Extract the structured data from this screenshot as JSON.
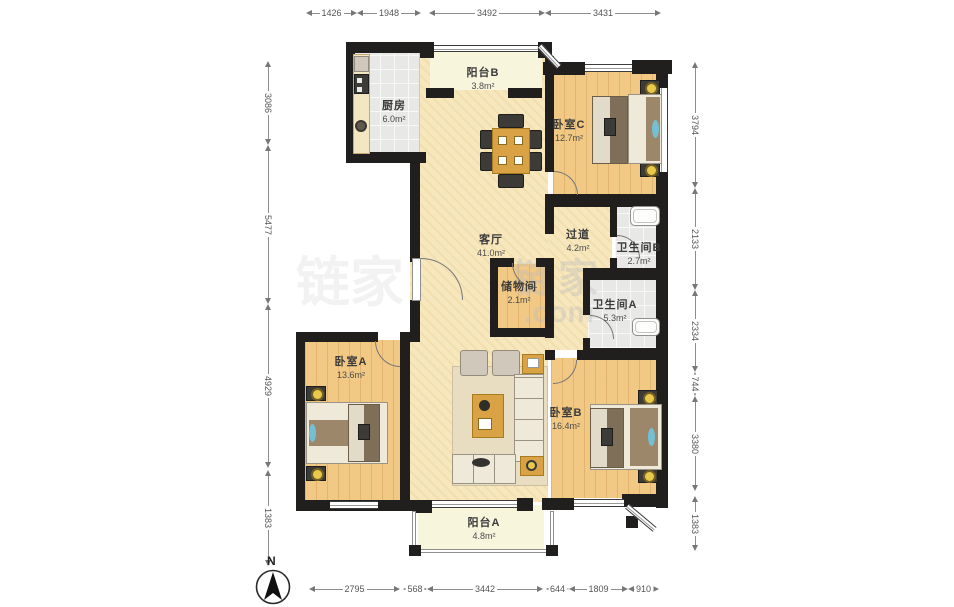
{
  "plan_title": "3室2厅户型图",
  "rooms": [
    {
      "id": "balcony-b",
      "name": "阳台B",
      "area": "3.8m²",
      "x": 483,
      "y": 64
    },
    {
      "id": "kitchen",
      "name": "厨房",
      "area": "6.0m²",
      "x": 394,
      "y": 97
    },
    {
      "id": "bedroom-c",
      "name": "卧室C",
      "area": "12.7m²",
      "x": 569,
      "y": 116
    },
    {
      "id": "living-room",
      "name": "客厅",
      "area": "41.0m²",
      "x": 491,
      "y": 231
    },
    {
      "id": "hallway",
      "name": "过道",
      "area": "4.2m²",
      "x": 578,
      "y": 226
    },
    {
      "id": "bathroom-b",
      "name": "卫生间B",
      "area": "2.7m²",
      "x": 639,
      "y": 239
    },
    {
      "id": "storage",
      "name": "储物间",
      "area": "2.1m²",
      "x": 519,
      "y": 278
    },
    {
      "id": "bathroom-a",
      "name": "卫生间A",
      "area": "5.3m²",
      "x": 615,
      "y": 296
    },
    {
      "id": "bedroom-a",
      "name": "卧室A",
      "area": "13.6m²",
      "x": 351,
      "y": 353
    },
    {
      "id": "bedroom-b",
      "name": "卧室B",
      "area": "16.4m²",
      "x": 566,
      "y": 404
    },
    {
      "id": "balcony-a",
      "name": "阳台A",
      "area": "4.8m²",
      "x": 484,
      "y": 514
    }
  ],
  "dimensions": {
    "top": {
      "pos": 13,
      "segments": [
        {
          "label": "1426",
          "from": 306,
          "to": 357
        },
        {
          "label": "1948",
          "from": 357,
          "to": 421
        },
        {
          "label": "3492",
          "from": 429,
          "to": 545
        },
        {
          "label": "3431",
          "from": 545,
          "to": 661
        }
      ]
    },
    "bottom": {
      "pos": 589,
      "segments": [
        {
          "label": "2795",
          "from": 309,
          "to": 400
        },
        {
          "label": "568",
          "from": 403,
          "to": 427
        },
        {
          "label": "3442",
          "from": 427,
          "to": 543
        },
        {
          "label": "644",
          "from": 546,
          "to": 569
        },
        {
          "label": "1809",
          "from": 569,
          "to": 628
        },
        {
          "label": "910",
          "from": 628,
          "to": 659
        }
      ]
    },
    "left": {
      "pos": 268,
      "segments": [
        {
          "label": "3086",
          "from": 61,
          "to": 145
        },
        {
          "label": "5477",
          "from": 145,
          "to": 304
        },
        {
          "label": "4929",
          "from": 304,
          "to": 468
        },
        {
          "label": "1383",
          "from": 470,
          "to": 566
        }
      ]
    },
    "right": {
      "pos": 695,
      "segments": [
        {
          "label": "3794",
          "from": 62,
          "to": 188
        },
        {
          "label": "2133",
          "from": 188,
          "to": 290
        },
        {
          "label": "2334",
          "from": 290,
          "to": 372
        },
        {
          "label": "744",
          "from": 372,
          "to": 396
        },
        {
          "label": "3380",
          "from": 396,
          "to": 491
        },
        {
          "label": "1383",
          "from": 496,
          "to": 551
        }
      ]
    }
  },
  "north": {
    "label": "N"
  },
  "watermark": {
    "cn": "链家",
    "com": ".com"
  }
}
